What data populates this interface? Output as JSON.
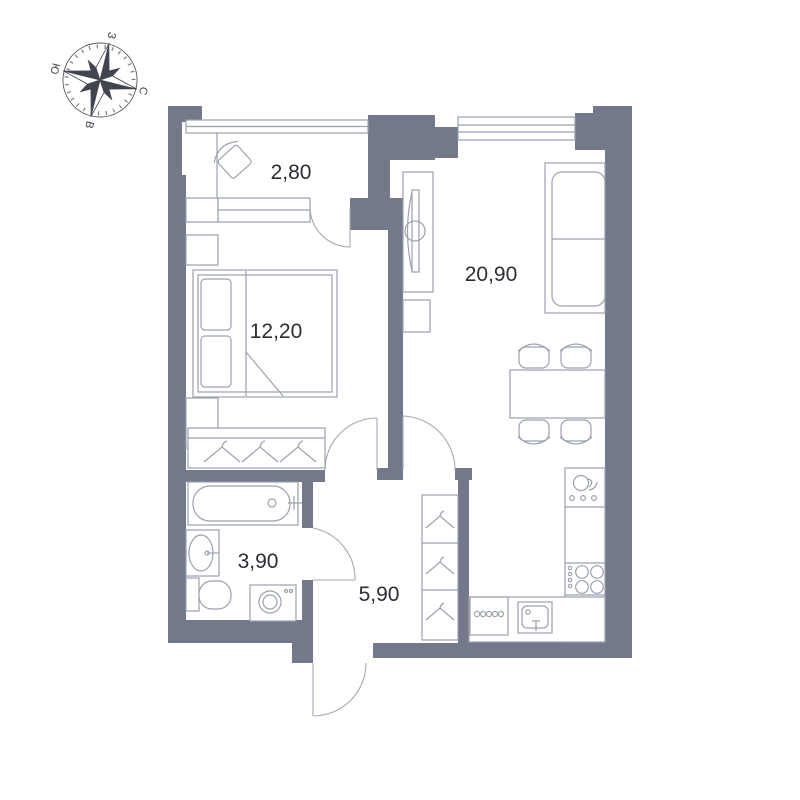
{
  "page": {
    "background": "#ffffff",
    "type": "apartment-floor-plan"
  },
  "compass": {
    "north_label": "С",
    "east_label": "В",
    "south_label": "Ю",
    "west_label": "З"
  },
  "rooms": [
    {
      "id": "balcony",
      "area_label": "2,80"
    },
    {
      "id": "bedroom",
      "area_label": "12,20"
    },
    {
      "id": "living-kitchen",
      "area_label": "20,90"
    },
    {
      "id": "bathroom",
      "area_label": "3,90"
    },
    {
      "id": "hallway",
      "area_label": "5,90"
    }
  ],
  "colors": {
    "wall": "#73788a",
    "furniture_line": "#9ba1ae",
    "label_text": "#2b2e33",
    "compass_ink": "#41454f",
    "background": "#ffffff"
  }
}
